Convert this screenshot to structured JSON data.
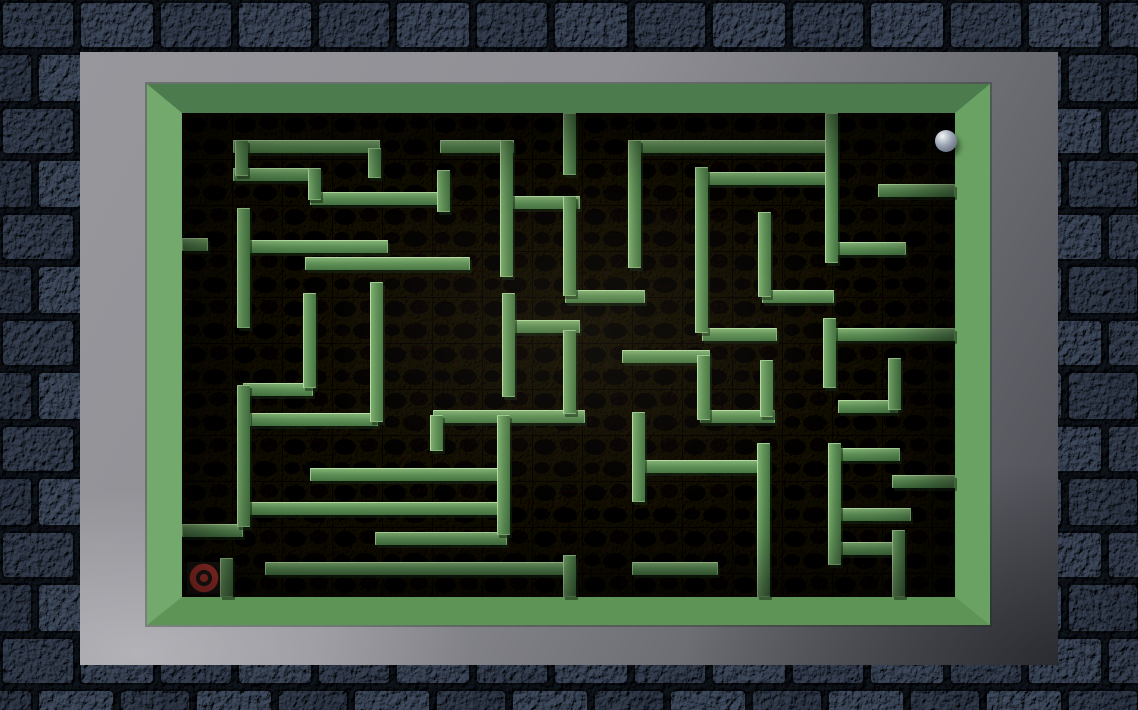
{
  "game": {
    "type": "tilt-marble-maze",
    "description_of_pixels": "Top-down 3D maze with green walls on dark floor, silver marble at top right, red bullseye goal at bottom left, gray panel and stone-brick border"
  },
  "theme": {
    "panelMid": "#97979c",
    "panelDark": "#4b4b53",
    "frameTop": "#4c7c4e",
    "frameLeft": "#74a96d",
    "frameRight": "#6aa263",
    "frameBottom": "#5e9557",
    "bevelTop": "#32503a",
    "bevelLeft": "#4b7a49",
    "bevelRight": "#8fc985",
    "bevelBottom": "#93cd89",
    "wallLight": "#b9e2a6",
    "wallMid": "#61955a",
    "wallDark": "#477743",
    "wallShadow": "rgba(22,42,20,0.55)",
    "floorBase": "#272119",
    "floorBlob": "#0e0c0a",
    "stoneMortar": "#161920",
    "stoneBase": "#414a59",
    "ballHi": "#f4f6f8",
    "ballMid": "#97a1b0",
    "ballDark": "#4e5766",
    "targetRed": "#c03a34",
    "targetDark": "#241d16"
  },
  "scene": {
    "stage": {
      "w": 1138,
      "h": 710
    },
    "stone_border": {
      "top": 52,
      "left": 80,
      "right": 80,
      "bottom": 45,
      "brick_w": 74,
      "brick_h": 47
    },
    "panel": {
      "x": 80,
      "y": 52,
      "w": 978,
      "h": 613
    },
    "frame": {
      "x": 147,
      "y": 84,
      "w": 843,
      "h": 541
    },
    "floor": {
      "x": 182,
      "y": 113,
      "w": 773,
      "h": 484
    },
    "ball": {
      "cx": 946,
      "cy": 141,
      "r": 11
    },
    "target": {
      "cx": 204,
      "cy": 578,
      "w": 34,
      "h": 32
    },
    "walls": {
      "thickness": 13,
      "h": [
        [
          233,
          140,
          147
        ],
        [
          233,
          168,
          85
        ],
        [
          310,
          192,
          138
        ],
        [
          182,
          238,
          26
        ],
        [
          245,
          240,
          143
        ],
        [
          305,
          257,
          165
        ],
        [
          243,
          383,
          70
        ],
        [
          250,
          413,
          128
        ],
        [
          310,
          468,
          195
        ],
        [
          245,
          502,
          262
        ],
        [
          182,
          524,
          61
        ],
        [
          375,
          532,
          132
        ],
        [
          265,
          562,
          310
        ],
        [
          440,
          140,
          74
        ],
        [
          505,
          196,
          75
        ],
        [
          565,
          290,
          80
        ],
        [
          630,
          140,
          202
        ],
        [
          703,
          172,
          130
        ],
        [
          505,
          320,
          75
        ],
        [
          622,
          350,
          88
        ],
        [
          433,
          410,
          152
        ],
        [
          638,
          460,
          126
        ],
        [
          700,
          410,
          75
        ],
        [
          878,
          184,
          77
        ],
        [
          830,
          242,
          76
        ],
        [
          762,
          290,
          72
        ],
        [
          702,
          328,
          75
        ],
        [
          827,
          328,
          128
        ],
        [
          838,
          400,
          60
        ],
        [
          830,
          448,
          70
        ],
        [
          835,
          508,
          76
        ],
        [
          835,
          542,
          65
        ],
        [
          892,
          475,
          63
        ],
        [
          632,
          562,
          86
        ]
      ],
      "v": [
        [
          235,
          140,
          36
        ],
        [
          308,
          168,
          32
        ],
        [
          368,
          148,
          30
        ],
        [
          237,
          208,
          120
        ],
        [
          303,
          293,
          95
        ],
        [
          370,
          282,
          140
        ],
        [
          237,
          385,
          142
        ],
        [
          497,
          415,
          120
        ],
        [
          563,
          113,
          62
        ],
        [
          500,
          140,
          137
        ],
        [
          563,
          196,
          100
        ],
        [
          628,
          140,
          128
        ],
        [
          695,
          167,
          166
        ],
        [
          502,
          293,
          104
        ],
        [
          563,
          330,
          84
        ],
        [
          563,
          555,
          42
        ],
        [
          632,
          412,
          90
        ],
        [
          697,
          355,
          65
        ],
        [
          760,
          360,
          57
        ],
        [
          757,
          443,
          154
        ],
        [
          825,
          113,
          150
        ],
        [
          758,
          212,
          85
        ],
        [
          823,
          318,
          70
        ],
        [
          828,
          443,
          122
        ],
        [
          888,
          358,
          52
        ],
        [
          892,
          530,
          67
        ],
        [
          220,
          558,
          39
        ],
        [
          430,
          415,
          36
        ],
        [
          437,
          170,
          42
        ]
      ]
    }
  }
}
